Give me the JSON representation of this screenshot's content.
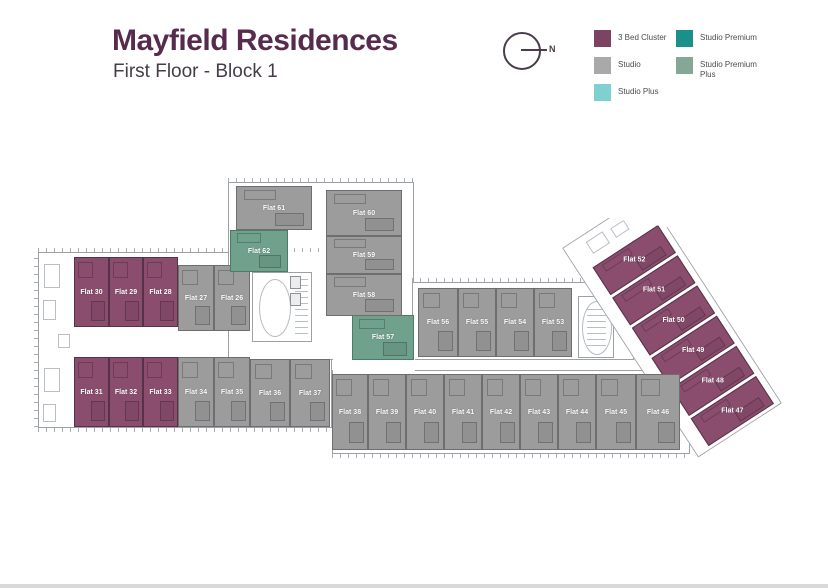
{
  "header": {
    "title": "Mayfield Residences",
    "subtitle": "First Floor - Block 1"
  },
  "compass": {
    "label": "N"
  },
  "legend": {
    "items": [
      {
        "label": "3 Bed Cluster",
        "color": "#7d4364"
      },
      {
        "label": "Studio",
        "color": "#a9a9a9"
      },
      {
        "label": "Studio Plus",
        "color": "#7fd1d1"
      },
      {
        "label": "Studio Premium",
        "color": "#19908a"
      },
      {
        "label": "Studio Premium Plus",
        "color": "#85a795"
      }
    ]
  },
  "floor_plan": {
    "types": {
      "cluster": {
        "name": "3 Bed Cluster",
        "color": "#8b4d6e",
        "border": "#573149"
      },
      "studio": {
        "name": "Studio",
        "color": "#9c9c9c",
        "border": "#6e6e6e"
      },
      "premium_plus": {
        "name": "Studio Premium Plus",
        "color": "#6fa18c",
        "border": "#4e7a66"
      }
    },
    "flats": [
      {
        "label": "Flat 26",
        "type": "studio",
        "wing": "main",
        "x": 214,
        "y": 265,
        "w": 36,
        "h": 66
      },
      {
        "label": "Flat 27",
        "type": "studio",
        "wing": "main",
        "x": 178,
        "y": 265,
        "w": 36,
        "h": 66
      },
      {
        "label": "Flat 28",
        "type": "cluster",
        "wing": "main",
        "x": 143,
        "y": 257,
        "w": 35,
        "h": 70
      },
      {
        "label": "Flat 29",
        "type": "cluster",
        "wing": "main",
        "x": 109,
        "y": 257,
        "w": 34,
        "h": 70
      },
      {
        "label": "Flat 30",
        "type": "cluster",
        "wing": "main",
        "x": 74,
        "y": 257,
        "w": 35,
        "h": 70
      },
      {
        "label": "Flat 31",
        "type": "cluster",
        "wing": "main",
        "x": 74,
        "y": 357,
        "w": 35,
        "h": 70
      },
      {
        "label": "Flat 32",
        "type": "cluster",
        "wing": "main",
        "x": 109,
        "y": 357,
        "w": 34,
        "h": 70
      },
      {
        "label": "Flat 33",
        "type": "cluster",
        "wing": "main",
        "x": 143,
        "y": 357,
        "w": 35,
        "h": 70
      },
      {
        "label": "Flat 34",
        "type": "studio",
        "wing": "main",
        "x": 178,
        "y": 357,
        "w": 36,
        "h": 70
      },
      {
        "label": "Flat 35",
        "type": "studio",
        "wing": "main",
        "x": 214,
        "y": 357,
        "w": 36,
        "h": 70
      },
      {
        "label": "Flat 36",
        "type": "studio",
        "wing": "main",
        "x": 250,
        "y": 359,
        "w": 40,
        "h": 68
      },
      {
        "label": "Flat 37",
        "type": "studio",
        "wing": "main",
        "x": 290,
        "y": 359,
        "w": 40,
        "h": 68
      },
      {
        "label": "Flat 38",
        "type": "studio",
        "wing": "main",
        "x": 332,
        "y": 374,
        "w": 36,
        "h": 76
      },
      {
        "label": "Flat 39",
        "type": "studio",
        "wing": "main",
        "x": 368,
        "y": 374,
        "w": 38,
        "h": 76
      },
      {
        "label": "Flat 40",
        "type": "studio",
        "wing": "main",
        "x": 406,
        "y": 374,
        "w": 38,
        "h": 76
      },
      {
        "label": "Flat 41",
        "type": "studio",
        "wing": "main",
        "x": 444,
        "y": 374,
        "w": 38,
        "h": 76
      },
      {
        "label": "Flat 42",
        "type": "studio",
        "wing": "main",
        "x": 482,
        "y": 374,
        "w": 38,
        "h": 76
      },
      {
        "label": "Flat 43",
        "type": "studio",
        "wing": "main",
        "x": 520,
        "y": 374,
        "w": 38,
        "h": 76
      },
      {
        "label": "Flat 44",
        "type": "studio",
        "wing": "main",
        "x": 558,
        "y": 374,
        "w": 38,
        "h": 76
      },
      {
        "label": "Flat 45",
        "type": "studio",
        "wing": "main",
        "x": 596,
        "y": 374,
        "w": 40,
        "h": 76
      },
      {
        "label": "Flat 46",
        "type": "studio",
        "wing": "main",
        "x": 636,
        "y": 374,
        "w": 44,
        "h": 76
      },
      {
        "label": "Flat 47",
        "type": "cluster",
        "wing": "tilted",
        "x": 14,
        "y": 212,
        "w": 78,
        "h": 33
      },
      {
        "label": "Flat 48",
        "type": "cluster",
        "wing": "tilted",
        "x": 14,
        "y": 176,
        "w": 78,
        "h": 33
      },
      {
        "label": "Flat 49",
        "type": "cluster",
        "wing": "tilted",
        "x": 14,
        "y": 140,
        "w": 78,
        "h": 33
      },
      {
        "label": "Flat 50",
        "type": "cluster",
        "wing": "tilted",
        "x": 14,
        "y": 104,
        "w": 78,
        "h": 33
      },
      {
        "label": "Flat 51",
        "type": "cluster",
        "wing": "tilted",
        "x": 14,
        "y": 68,
        "w": 78,
        "h": 33
      },
      {
        "label": "Flat 52",
        "type": "cluster",
        "wing": "tilted",
        "x": 14,
        "y": 32,
        "w": 78,
        "h": 33
      },
      {
        "label": "Flat 53",
        "type": "studio",
        "wing": "main",
        "x": 534,
        "y": 288,
        "w": 38,
        "h": 69
      },
      {
        "label": "Flat 54",
        "type": "studio",
        "wing": "main",
        "x": 496,
        "y": 288,
        "w": 38,
        "h": 69
      },
      {
        "label": "Flat 55",
        "type": "studio",
        "wing": "main",
        "x": 458,
        "y": 288,
        "w": 38,
        "h": 69
      },
      {
        "label": "Flat 56",
        "type": "studio",
        "wing": "main",
        "x": 418,
        "y": 288,
        "w": 40,
        "h": 69
      },
      {
        "label": "Flat 57",
        "type": "premium_plus",
        "wing": "main",
        "x": 352,
        "y": 315,
        "w": 62,
        "h": 45
      },
      {
        "label": "Flat 58",
        "type": "studio",
        "wing": "main",
        "x": 326,
        "y": 274,
        "w": 76,
        "h": 42
      },
      {
        "label": "Flat 59",
        "type": "studio",
        "wing": "main",
        "x": 326,
        "y": 236,
        "w": 76,
        "h": 38
      },
      {
        "label": "Flat 60",
        "type": "studio",
        "wing": "main",
        "x": 326,
        "y": 190,
        "w": 76,
        "h": 46
      },
      {
        "label": "Flat 61",
        "type": "studio",
        "wing": "main",
        "x": 236,
        "y": 186,
        "w": 76,
        "h": 44
      },
      {
        "label": "Flat 62",
        "type": "premium_plus",
        "wing": "main",
        "x": 230,
        "y": 230,
        "w": 58,
        "h": 42
      }
    ]
  }
}
